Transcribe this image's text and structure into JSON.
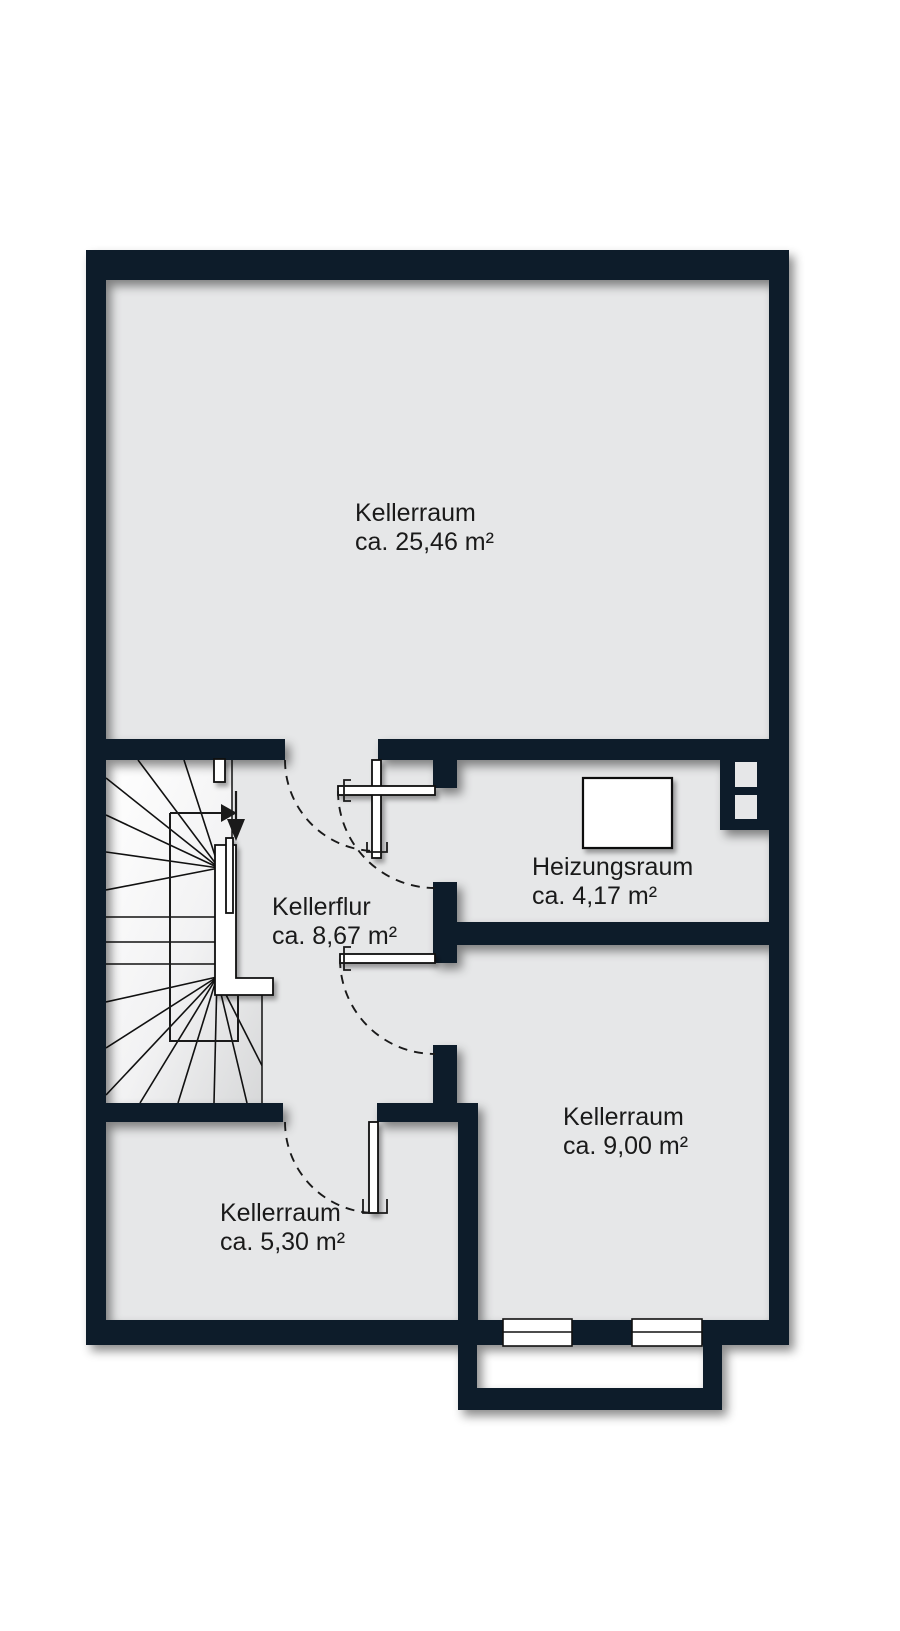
{
  "plan": {
    "kind": "basement floor plan",
    "rooms": [
      {
        "name": "Kellerraum",
        "area": "ca. 25,46 m²"
      },
      {
        "name": "Kellerflur",
        "area": "ca. 8,67 m²"
      },
      {
        "name": "Heizungsraum",
        "area": "ca. 4,17 m²"
      },
      {
        "name": "Kellerraum",
        "area": "ca. 9,00 m²"
      },
      {
        "name": "Kellerraum",
        "area": "ca. 5,30 m²"
      }
    ],
    "colors": {
      "wall": "#0c1a29",
      "floor": "#e6e7e8",
      "background": "#ffffff",
      "line": "#111111",
      "text": "#1a1a1a",
      "fixture": "#ffffff"
    }
  }
}
